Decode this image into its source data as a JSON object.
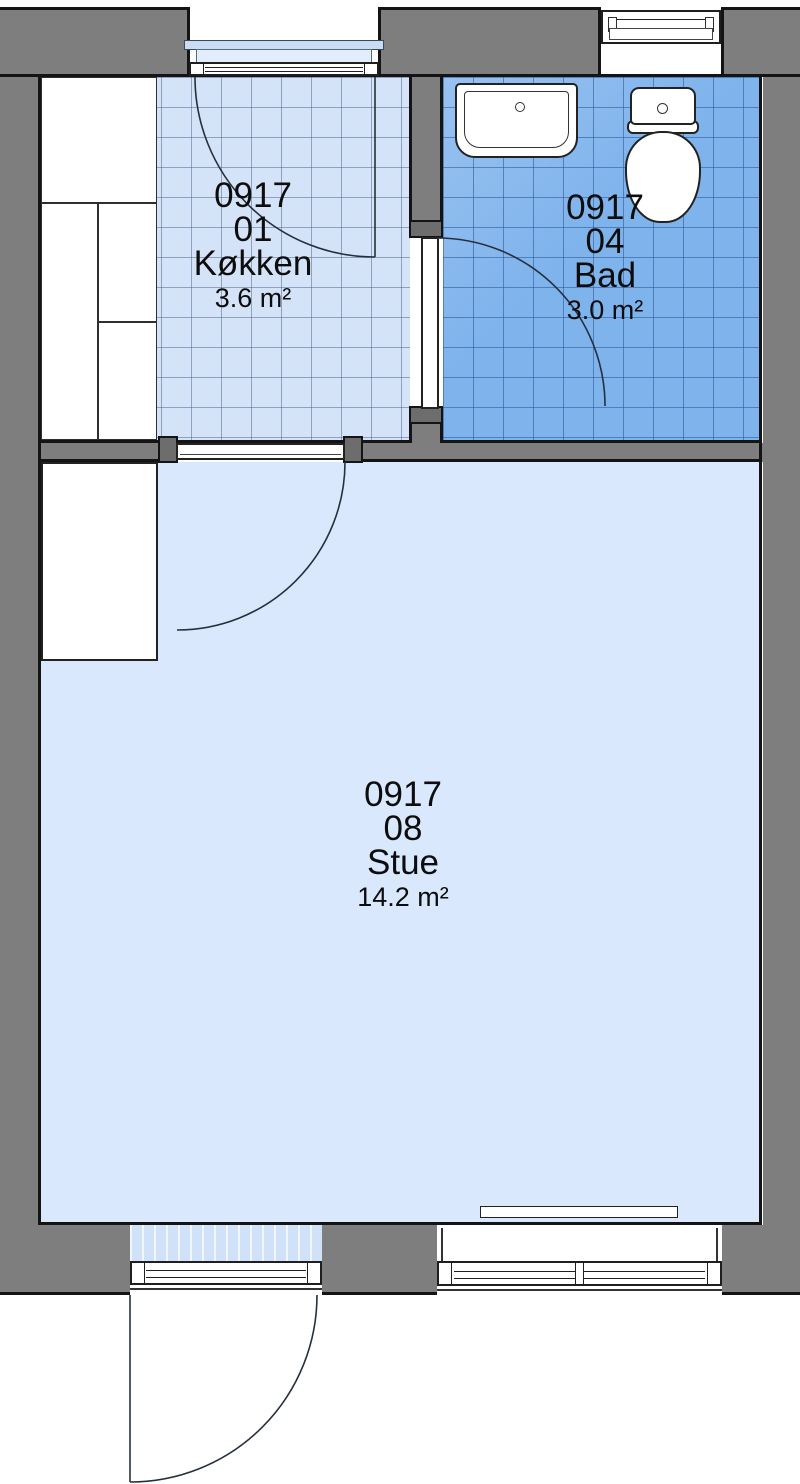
{
  "plan": {
    "rooms": {
      "kitchen": {
        "code": "0917",
        "number": "01",
        "name": "Køkken",
        "area": "3.6 m²"
      },
      "bath": {
        "code": "0917",
        "number": "04",
        "name": "Bad",
        "area": "3.0 m²"
      },
      "stue": {
        "code": "0917",
        "number": "08",
        "name": "Stue",
        "area": "14.2 m²"
      }
    },
    "colors": {
      "wall_gray": "#7e7e7e",
      "outline_black": "#141414",
      "kitchen_floor_blue": "#d4e3f8",
      "bath_floor_blue": "#7fb3ec",
      "stue_floor_blue": "#d9e8fc"
    },
    "fixtures": {
      "sink": "sink",
      "toilet": "toilet",
      "radiator": "radiator",
      "closet": "closet",
      "kitchen_cabinets": "kitchen-cabinets"
    }
  }
}
